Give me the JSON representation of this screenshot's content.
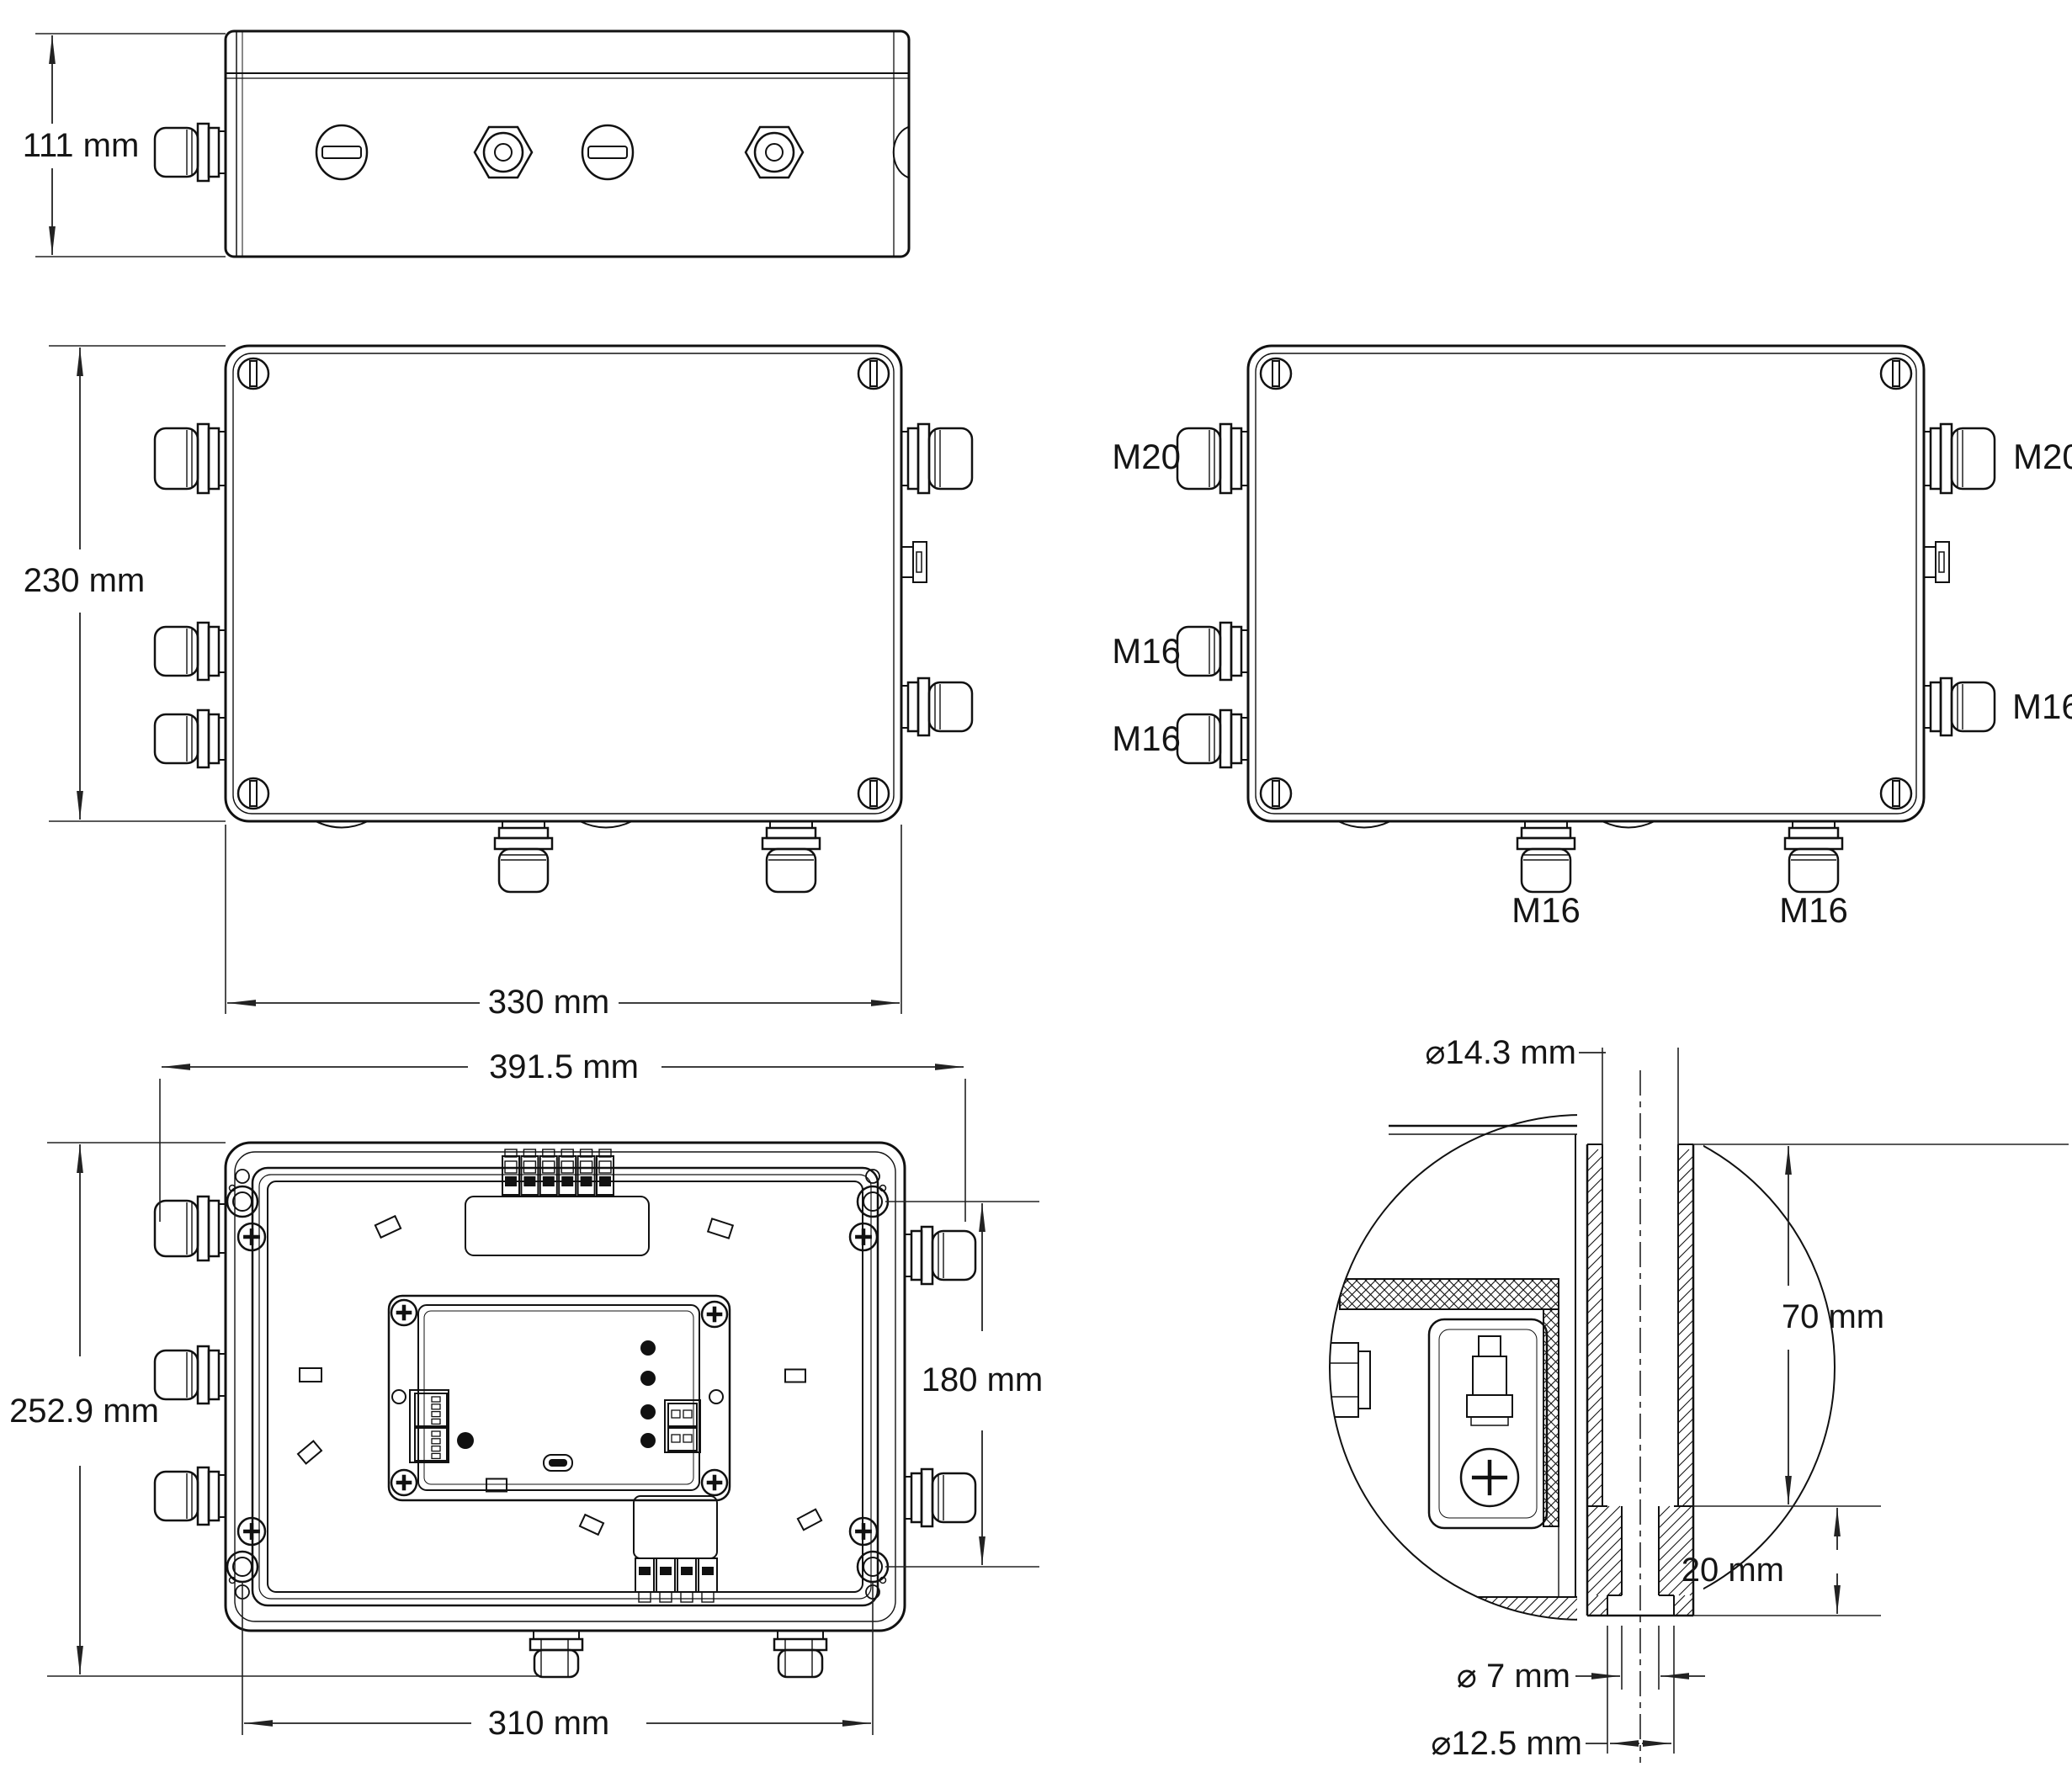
{
  "views": {
    "side": {
      "height": "111 mm"
    },
    "front": {
      "height": "230 mm",
      "width": "330 mm"
    },
    "glands": {
      "left_top": "M20",
      "left_mid": "M16",
      "left_bottom": "M16",
      "right_top": "M20",
      "right_bottom": "M16",
      "bottom_left": "M16",
      "bottom_right": "M16"
    },
    "open": {
      "width_overall": "391.5 mm",
      "height_overall": "252.9 mm",
      "mount_height": "180 mm",
      "mount_width": "310 mm"
    },
    "detail": {
      "sleeve_dia": "⌀14.3 mm",
      "sleeve_depth": "70 mm",
      "boss_depth": "20 mm",
      "screw_hole_dia": "⌀ 7 mm",
      "counterbore_dia": "⌀12.5 mm"
    }
  },
  "colors": {
    "line": "#111111",
    "background": "#ffffff"
  }
}
